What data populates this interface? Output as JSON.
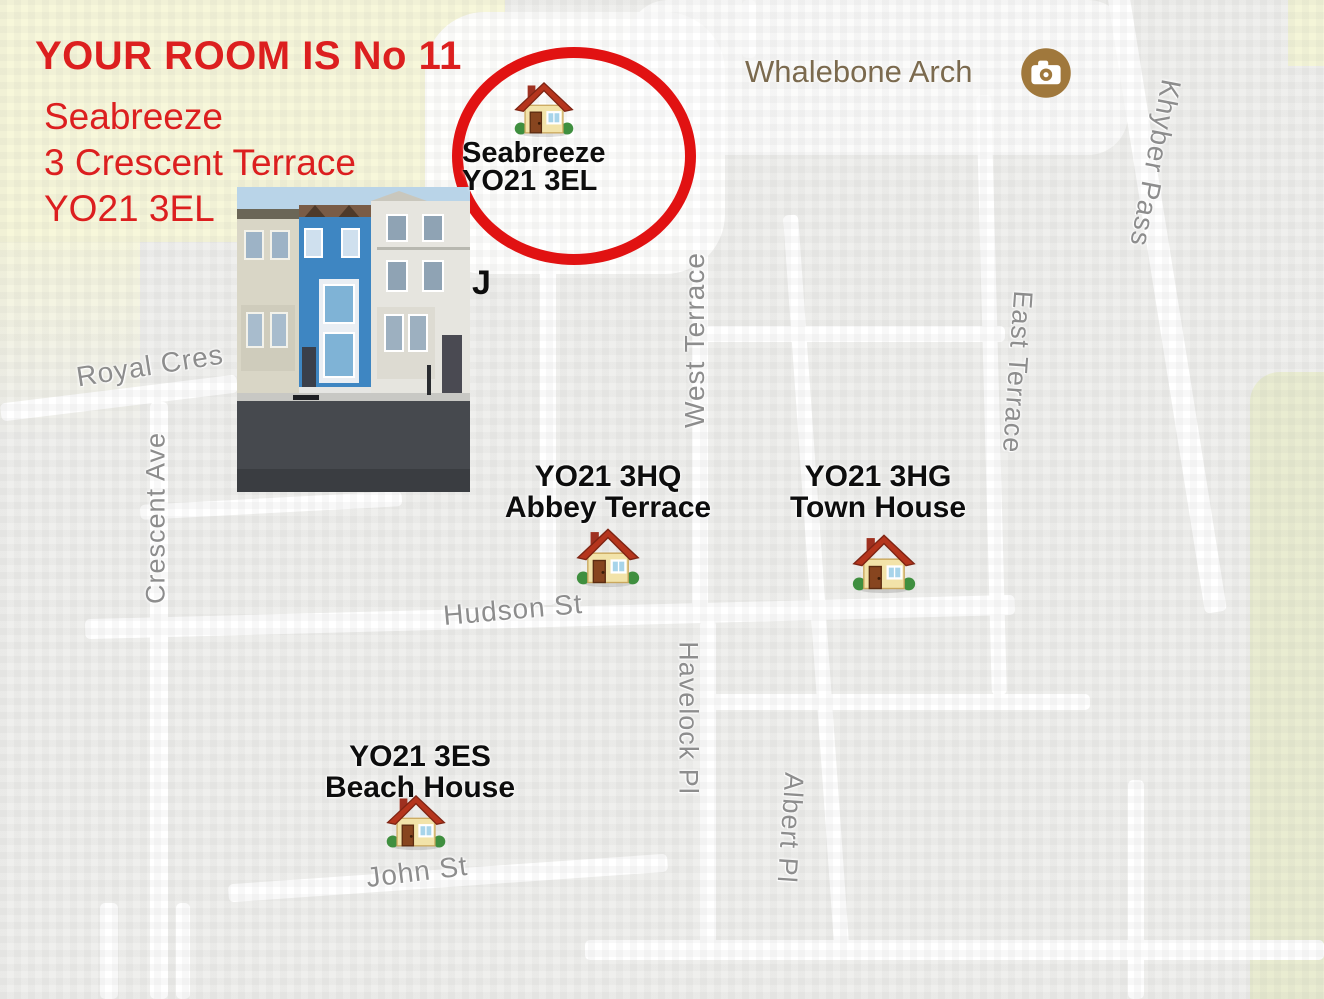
{
  "title": {
    "headline": "YOUR ROOM IS No 11",
    "address_line1": "Seabreeze",
    "address_line2": "3 Crescent Terrace",
    "address_line3": "YO21 3EL"
  },
  "highlight": {
    "name": "Seabreeze",
    "postcode": "YO21 3EL",
    "partial_text": "J"
  },
  "poi": {
    "name": "Whalebone Arch",
    "icon": "camera-icon"
  },
  "markers": [
    {
      "postcode": "YO21 3HQ",
      "name": "Abbey Terrace",
      "icon": "house-icon"
    },
    {
      "postcode": "YO21 3HG",
      "name": "Town House",
      "icon": "house-icon"
    },
    {
      "postcode": "YO21 3ES",
      "name": "Beach House",
      "icon": "house-icon"
    }
  ],
  "streets": [
    {
      "name": "Royal Cres"
    },
    {
      "name": "Crescent Ave"
    },
    {
      "name": "West Terrace"
    },
    {
      "name": "East Terrace"
    },
    {
      "name": "Khyber Pass"
    },
    {
      "name": "Hudson St"
    },
    {
      "name": "Havelock Pl"
    },
    {
      "name": "Albert Pl"
    },
    {
      "name": "John St"
    }
  ],
  "colors": {
    "annotation_red": "#dc1f1f",
    "circle_red": "#e11212",
    "marker_text": "#0d0d0d",
    "street_gray": "#8d8d8d",
    "poi_brown": "#7b6a4e",
    "camera_circle": "#a0783c",
    "map_background": "#efefed",
    "road_white": "#ffffff",
    "sand": "#f7f7da",
    "park": "#e9ecd1"
  }
}
